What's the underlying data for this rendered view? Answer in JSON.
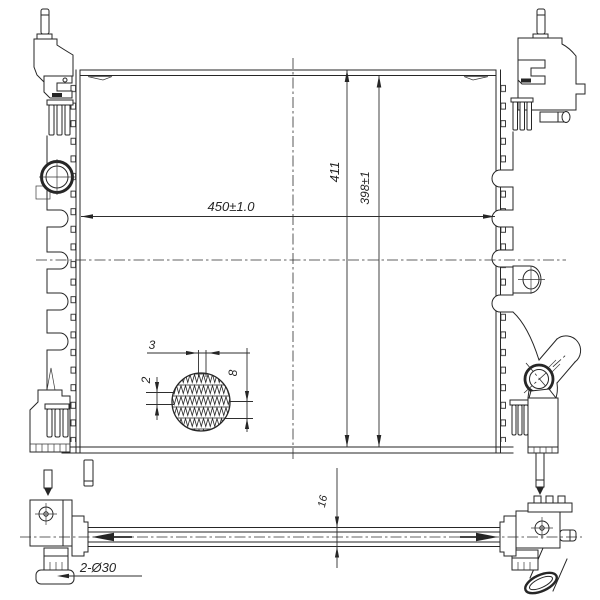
{
  "drawing": {
    "dimensions": {
      "core_width": "450±1.0",
      "overall_height": "411",
      "core_height": "398±1",
      "fin_detail_pitch": "3",
      "fin_detail_height": "2",
      "fin_detail_depth": "8",
      "core_thickness": "16",
      "mounting_pin_note": "2-Ø30"
    },
    "colors": {
      "line": "#262626",
      "background": "#ffffff"
    }
  }
}
